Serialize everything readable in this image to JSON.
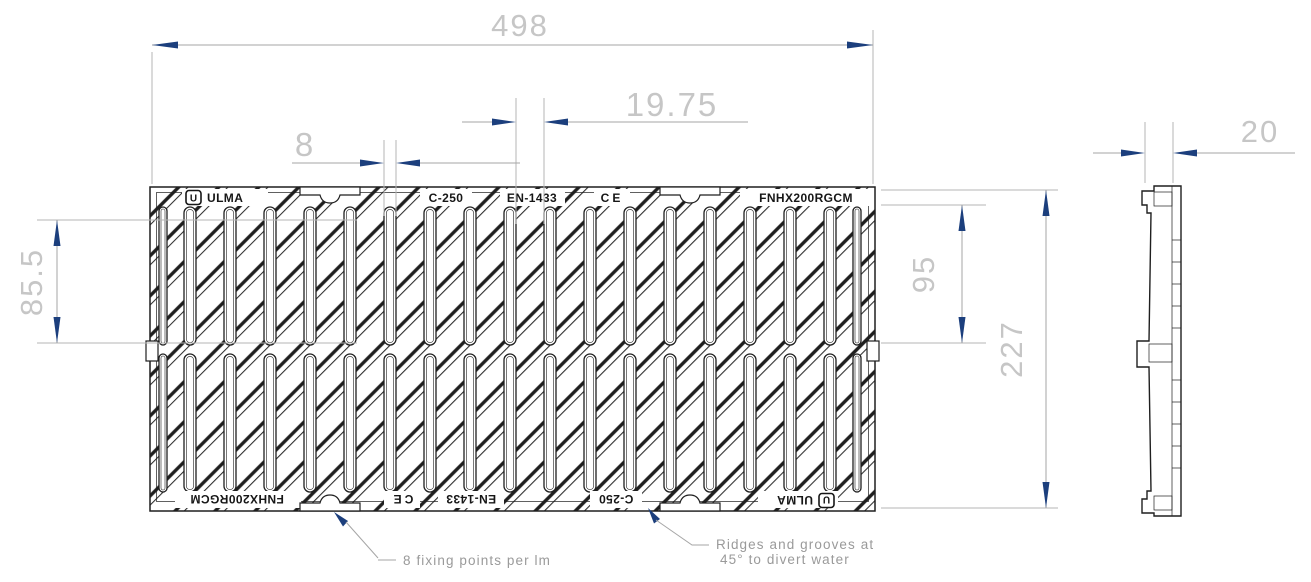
{
  "drawing": {
    "title": "Drainage grate technical drawing (plan view and side view)",
    "dimensions": {
      "overall_width": "498",
      "groove_spacing": "19.75",
      "slot_width": "8",
      "slot_offset_left": "85.5",
      "slot_length": "95",
      "overall_depth": "227",
      "thickness": "20"
    },
    "markings": {
      "brand": "ULMA",
      "brand_initial": "U",
      "load_class": "C-250",
      "standard": "EN-1433",
      "ce": "CE",
      "product_code": "FNHX200RGCM"
    },
    "annotations": {
      "fixing": "8 fixing points per lm",
      "ridges_1": "Ridges and grooves at",
      "ridges_2": "45° to divert water"
    },
    "colors": {
      "line": "#1f1f1f",
      "arrow": "#1c3f7d",
      "dim_text": "#c6c6c6",
      "dim_line": "#a6a6a6",
      "ext_line": "#b5b5b5",
      "annotation": "#9a9a9a"
    }
  }
}
